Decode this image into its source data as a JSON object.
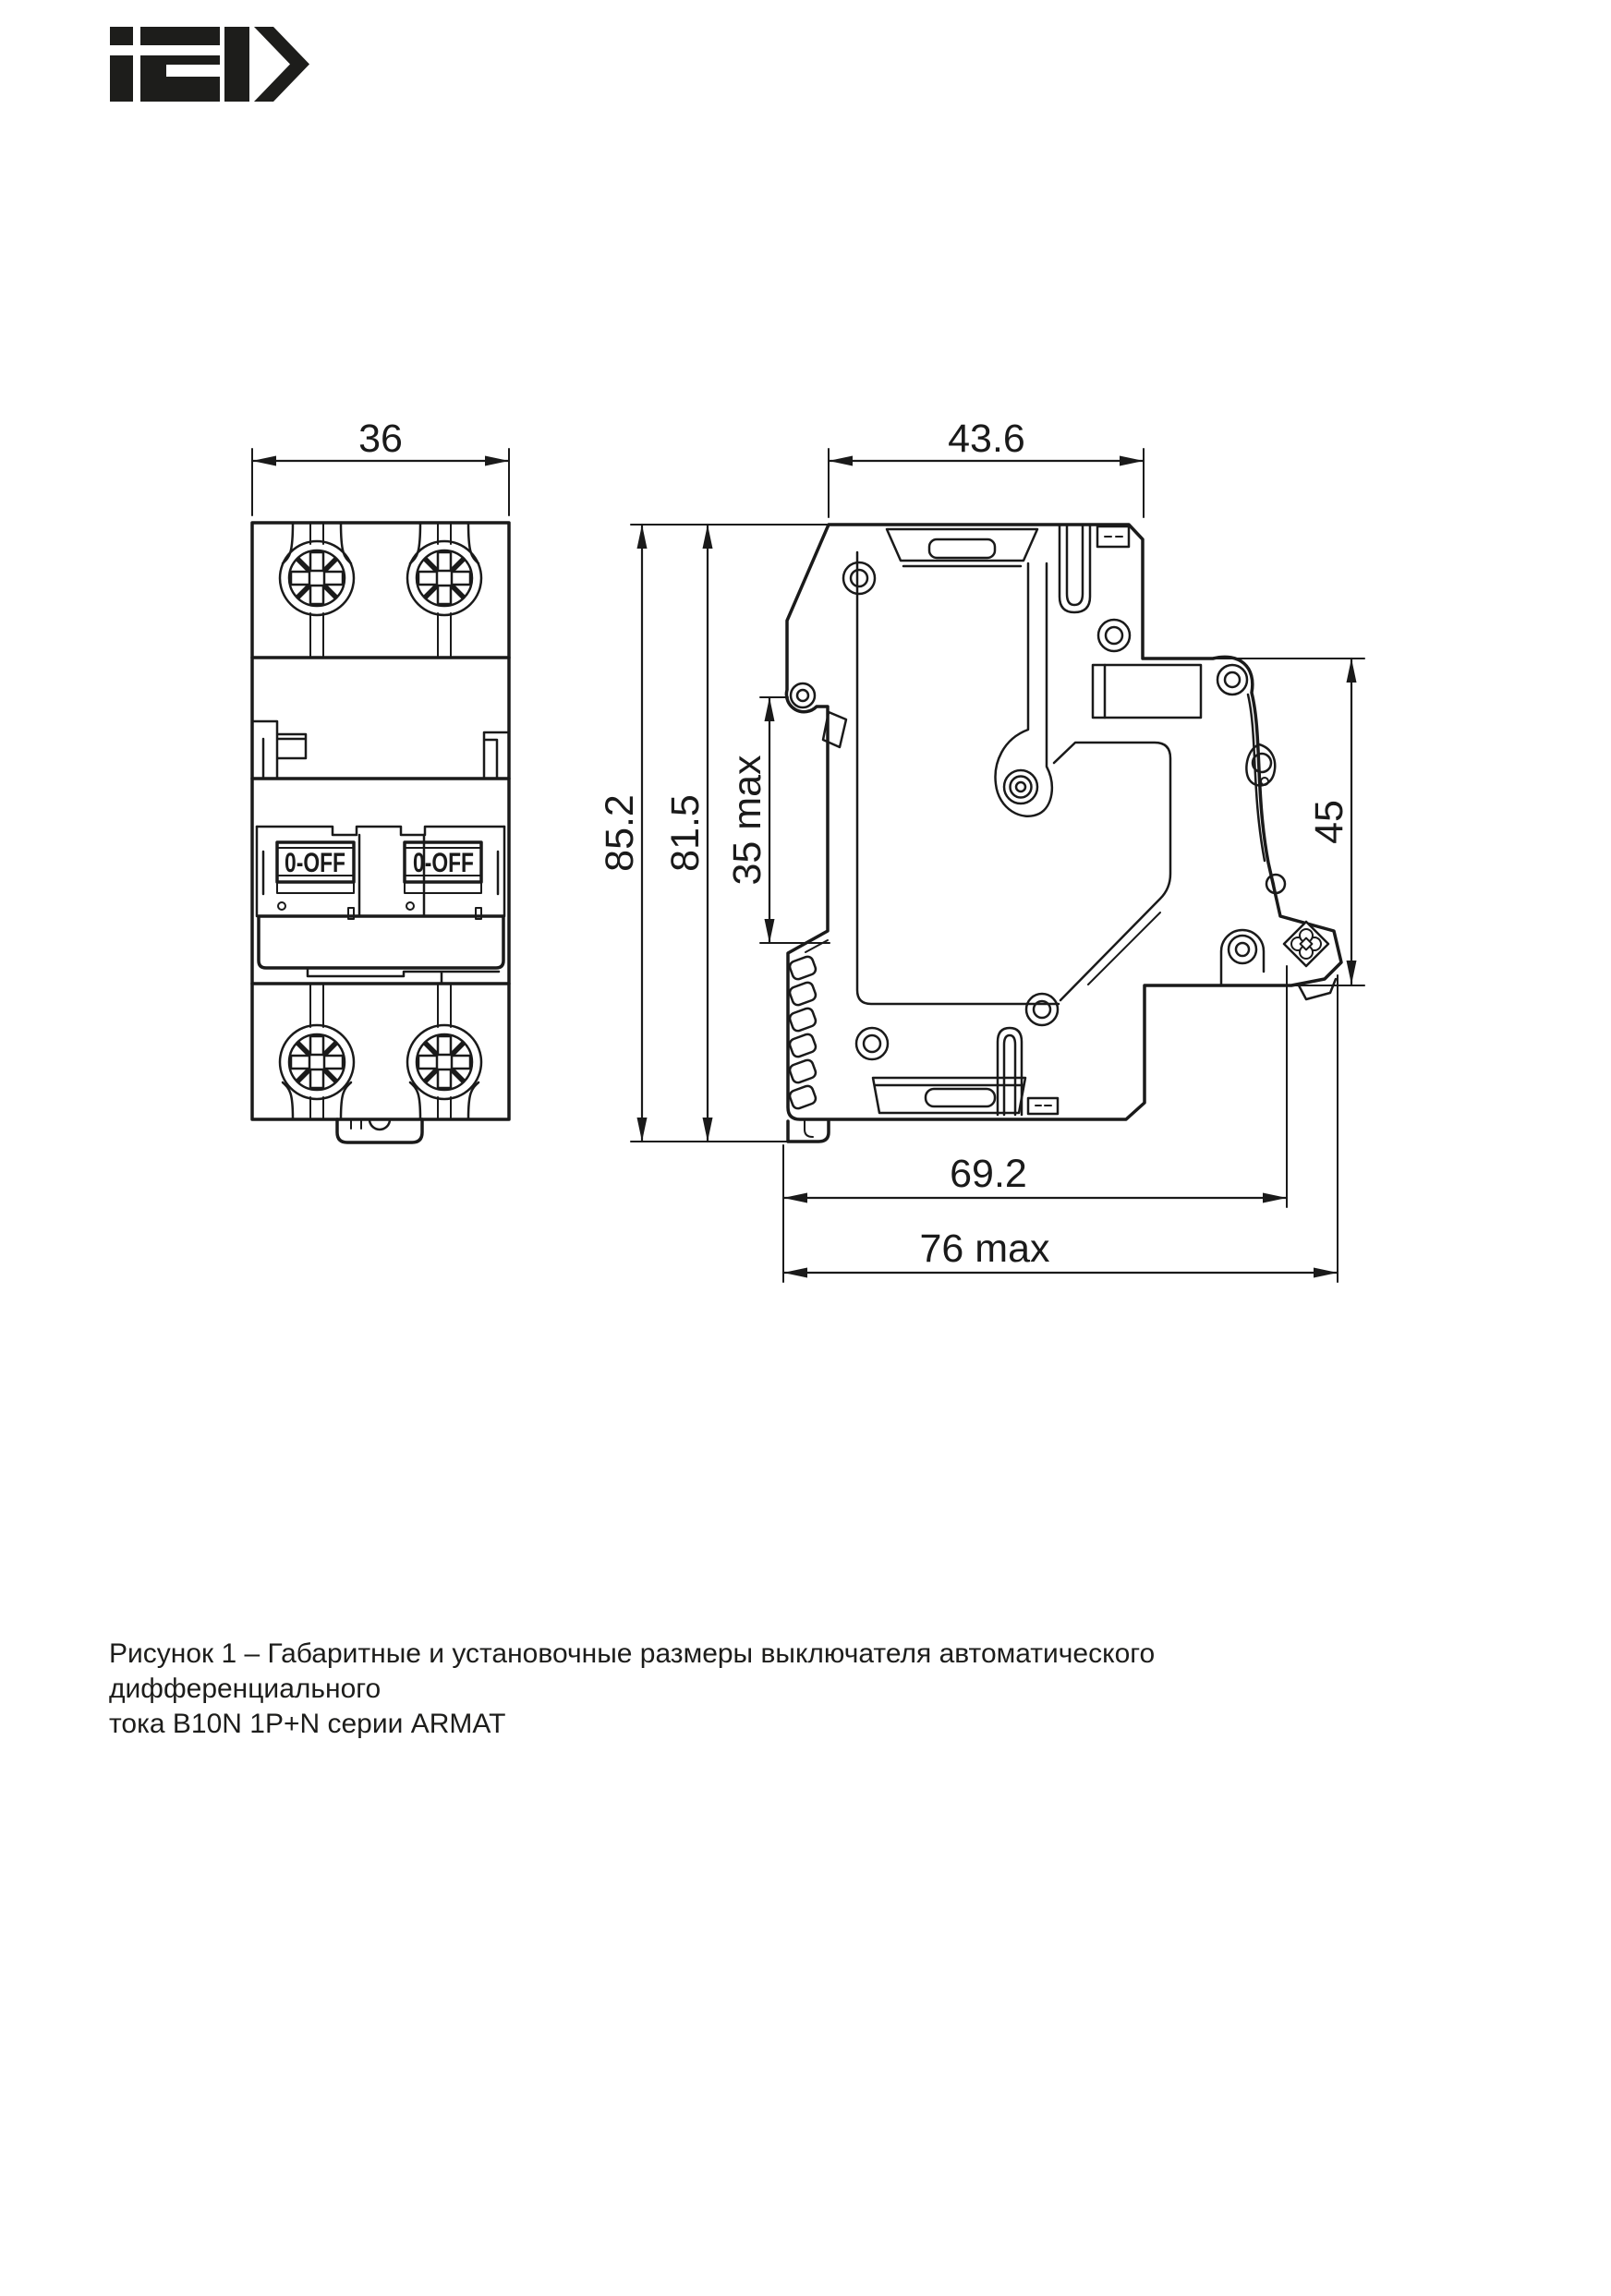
{
  "logo": {
    "text": "IEK",
    "color": "#1d1d1b"
  },
  "drawing": {
    "front_view": {
      "width_dim": "36",
      "toggle_left": "0-OFF",
      "toggle_right": "0-OFF"
    },
    "side_view": {
      "depth_dim": "43.6",
      "overall_height_dim": "85.2",
      "body_height_dim": "81.5",
      "din_rail_dim": "35 max",
      "terminal_zone_dim": "45",
      "mount_depth_dim": "69.2",
      "max_depth_dim": "76 max"
    }
  },
  "caption": {
    "line1": "Рисунок 1 – Габаритные и установочные размеры выключателя автоматического дифференциального",
    "line2": "тока B10N 1P+N серии ARMAT"
  }
}
